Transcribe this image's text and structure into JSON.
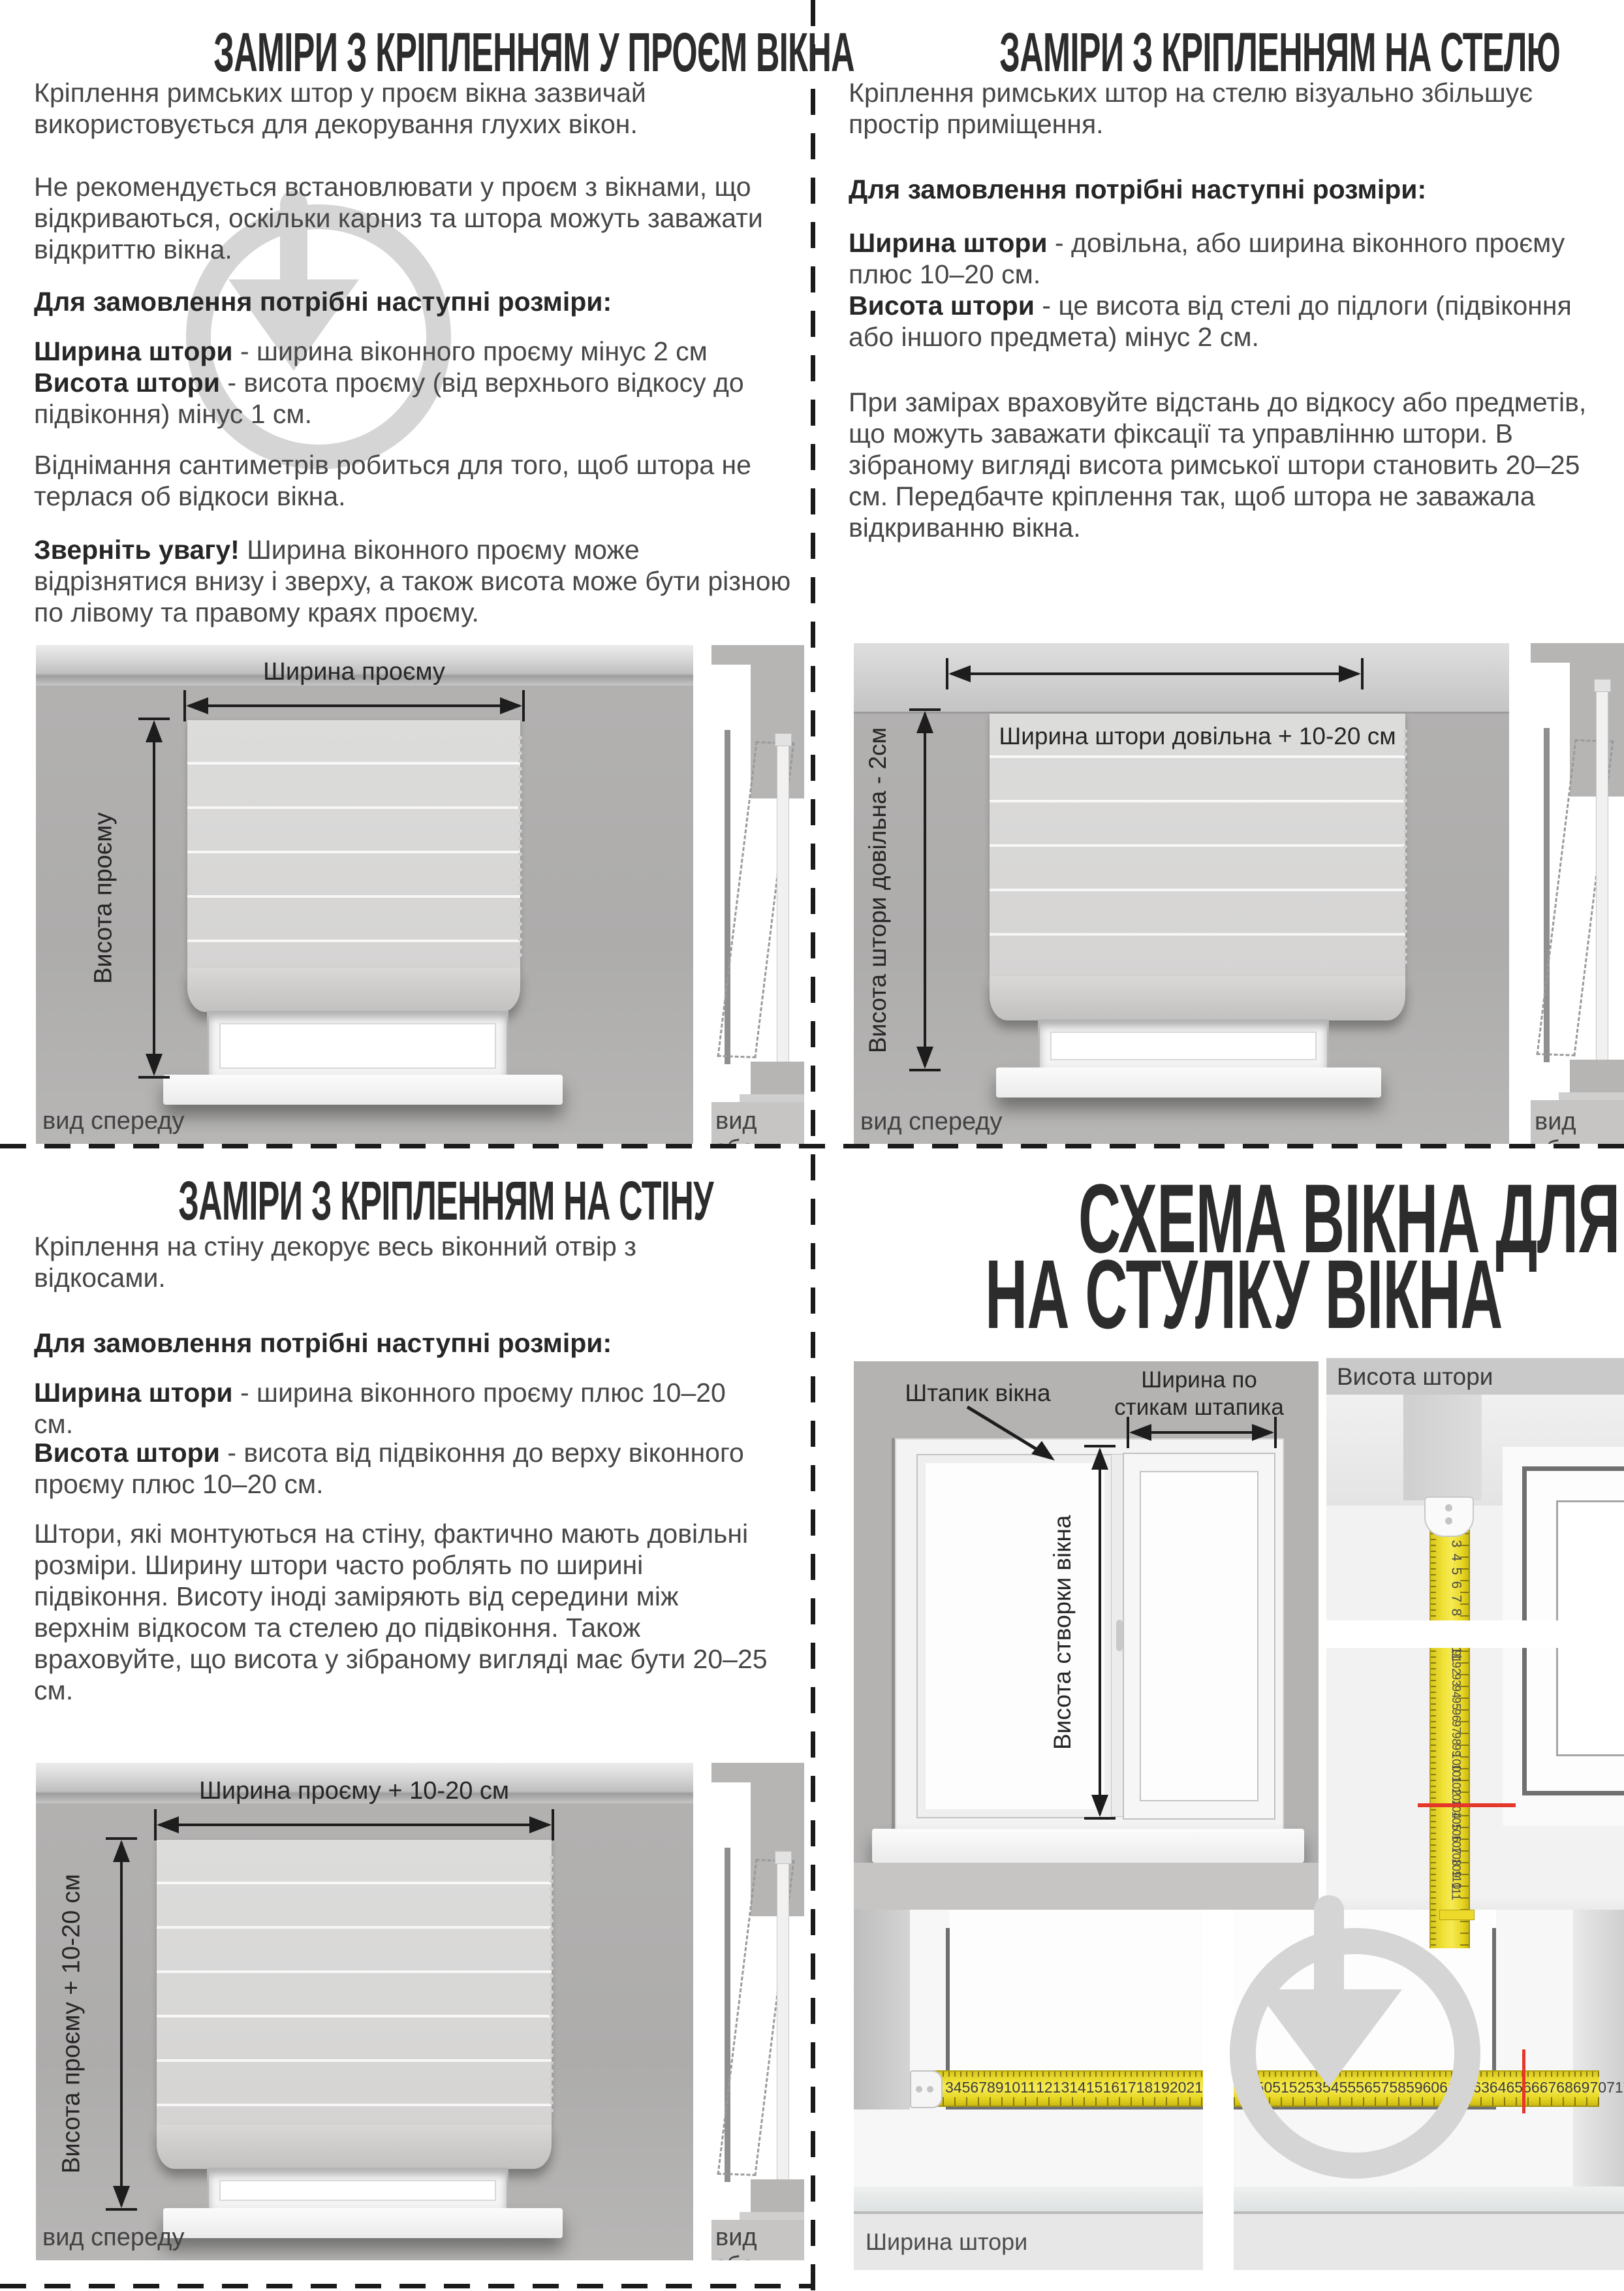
{
  "q1": {
    "title": "ЗАМІРИ З КРІПЛЕННЯМ У ПРОЄМ ВІКНА",
    "p1": "Кріплення римських штор у проєм вікна зазвичай використовується для декорування глухих вікон.",
    "p2": "Не рекомендується встановлювати у проєм з вікнами, що відкриваються, оскільки карниз та штора можуть заважати відкриттю вікна.",
    "order_heading": "Для замовлення потрібні наступні розміри:",
    "li1_b": "Ширина штори",
    "li1_t": " - ширина віконного проєму мінус 2 см",
    "li2_b": "Висота штори",
    "li2_t": " - висота проєму (від верхнього відкосу до підвіконня) мінус 1 см.",
    "p3": "Віднімання сантиметрів робиться для того, щоб штора не терлася об відкоси вікна.",
    "note_b": "Зверніть увагу!",
    "note_t": " Ширина віконного проєму може відрізнятися внизу і зверху, а також висота може бути різною по лівому та правому краях проєму.",
    "d_width": "Ширина проєму",
    "d_height": "Висота проєму",
    "front_view": "вид спереду",
    "side_view": "вид збоку"
  },
  "q2": {
    "title": "ЗАМІРИ З КРІПЛЕННЯМ НА СТЕЛЮ",
    "p1": "Кріплення римських штор на стелю візуально збільшує простір приміщення.",
    "order_heading": "Для замовлення потрібні наступні розміри:",
    "li1_b": "Ширина штори",
    "li1_t": " - довільна, або ширина віконного проєму плюс 10–20 см.",
    "li2_b": "Висота штори",
    "li2_t": " - це висота від стелі до підлоги (підвіконня або іншого предмета) мінус 2 см.",
    "p2": "При замірах враховуйте відстань до відкосу або предметів, що можуть заважати фіксації та управлінню штори. В зібраному вигляді висота римської штори становить 20–25 см. Передбачте кріплення так, щоб штора не заважала відкриванню вікна.",
    "d_width": "Ширина штори довільна + 10-20 см",
    "d_height": "Висота штори довільна - 2см",
    "front_view": "вид спереду",
    "side_view": "вид збоку"
  },
  "q3": {
    "title": "ЗАМІРИ З КРІПЛЕННЯМ НА СТІНУ",
    "p1": "Кріплення на стіну декорує весь віконний отвір з відкосами.",
    "order_heading": "Для замовлення потрібні наступні розміри:",
    "li1_b": "Ширина штори",
    "li1_t": " - ширина віконного проєму плюс 10–20 см.",
    "li2_b": "Висота штори",
    "li2_t": " - висота від підвіконня до верху віконного проєму плюс 10–20 см.",
    "p2": "Штори, які монтуються на стіну, фактично мають довільні розміри. Ширину штори часто роблять по ширині підвіконня. Висоту іноді заміряють від середини між верхнім відкосом та стелею до підвіконня. Також враховуйте, що висота у зібраному вигляді має бути 20–25 см.",
    "d_width": "Ширина проєму + 10-20 см",
    "d_height": "Висота проєму + 10-20 см",
    "front_view": "вид спереду",
    "side_view": "вид збоку"
  },
  "q4": {
    "title1": "СХЕМА ВІКНА ДЛЯ ЗАМІРІВ",
    "title2": "НА СТУЛКУ ВІКНА",
    "bead_label": "Штапик вікна",
    "joint_width_label": "Ширина по стикам штапика",
    "sash_height_label": "Висота створки вікна",
    "height_panel": {
      "header": "Висота штори",
      "tape_top_numbers": [
        3,
        4,
        5,
        6,
        7,
        8,
        9,
        10,
        11
      ],
      "tape_bottom_numbers": [
        91,
        92,
        93,
        94,
        95,
        96,
        97,
        98,
        99,
        100,
        101,
        102,
        103,
        104,
        105,
        106,
        107,
        108,
        109,
        110,
        111
      ],
      "red_at": 104
    },
    "width_panel": {
      "label": "Ширина штори",
      "tape_left_numbers": [
        3,
        4,
        5,
        6,
        7,
        8,
        9,
        10,
        11,
        12,
        13,
        14,
        15,
        16,
        17,
        18,
        19,
        20,
        21,
        22,
        23,
        24
      ],
      "tape_right_numbers": [
        49,
        50,
        51,
        52,
        53,
        54,
        55,
        56,
        57,
        58,
        59,
        60,
        61,
        62,
        63,
        64,
        65,
        66,
        67,
        68,
        69,
        70,
        71,
        72,
        73,
        74,
        75,
        76,
        77,
        78,
        79
      ],
      "red_at": 73
    }
  },
  "colors": {
    "tape_yellow": "#f1e339",
    "red_mark": "#e5382b",
    "watermark": "#d5d5d5",
    "fold_line": "#1b1b1b",
    "wall_gray": "#b3b2b1"
  }
}
